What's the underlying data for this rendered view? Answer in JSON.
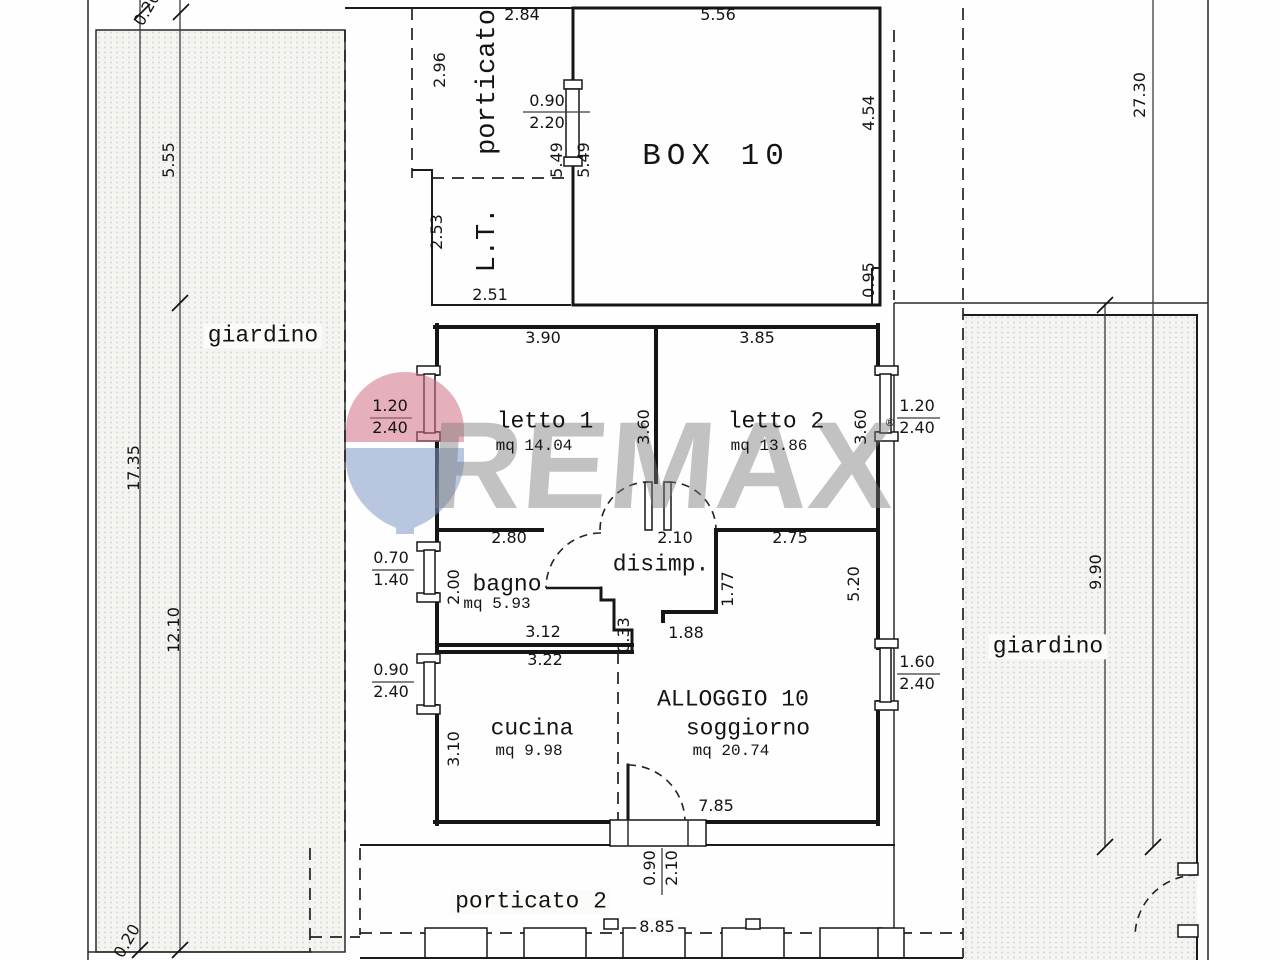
{
  "watermark": {
    "brand": "REMAX",
    "balloon_top_color": "#cf6d84",
    "balloon_bottom_color": "#7d99c4",
    "text_color": "rgba(122,122,122,0.45)"
  },
  "plan": {
    "unit": "ALLOGGIO 10",
    "rooms": [
      {
        "name": "porticato"
      },
      {
        "name": "L.T."
      },
      {
        "name": "BOX 10"
      },
      {
        "name": "letto 1",
        "area": "mq 14.04"
      },
      {
        "name": "letto 2",
        "area": "mq 13.86"
      },
      {
        "name": "bagno",
        "area": "mq 5.93"
      },
      {
        "name": "disimp."
      },
      {
        "name": "cucina",
        "area": "mq 9.98"
      },
      {
        "name": "soggiorno",
        "area": "mq 20.74"
      },
      {
        "name": "giardino"
      },
      {
        "name": "giardino"
      },
      {
        "name": "porticato 2"
      }
    ],
    "labels": [
      {
        "n": "room-label-porticato",
        "t": "porticato",
        "x": 489,
        "y": 82,
        "r": -90,
        "s": 27,
        "c": "r"
      },
      {
        "n": "dim-2-84",
        "t": "2.84",
        "x": 522,
        "y": 15
      },
      {
        "n": "dim-5-56",
        "t": "5.56",
        "x": 718,
        "y": 15
      },
      {
        "n": "dim-2-96",
        "t": "2.96",
        "x": 440,
        "y": 70,
        "r": -90
      },
      {
        "n": "dim-0-90-box-door",
        "t": "0.90",
        "x": 547,
        "y": 101
      },
      {
        "n": "dim-2-20-box-door",
        "t": "2.20",
        "x": 547,
        "y": 123
      },
      {
        "n": "dim-5-49-a",
        "t": "5.49",
        "x": 557,
        "y": 160,
        "r": -90
      },
      {
        "n": "dim-5-49-b",
        "t": "5.49",
        "x": 584,
        "y": 160,
        "r": -90
      },
      {
        "n": "room-label-lt",
        "t": "L.T.",
        "x": 489,
        "y": 240,
        "r": -90,
        "s": 27,
        "c": "r"
      },
      {
        "n": "dim-2-53",
        "t": "2.53",
        "x": 437,
        "y": 232,
        "r": -90
      },
      {
        "n": "dim-2-51",
        "t": "2.51",
        "x": 490,
        "y": 295
      },
      {
        "n": "room-label-box-10",
        "t": "BOX 10",
        "x": 716,
        "y": 157,
        "s": 31,
        "c": "b"
      },
      {
        "n": "dim-4-54",
        "t": "4.54",
        "x": 869,
        "y": 113,
        "r": -90
      },
      {
        "n": "dim-0-95",
        "t": "0.95",
        "x": 869,
        "y": 280,
        "r": -90
      },
      {
        "n": "room-label-giardino-left",
        "t": "giardino",
        "x": 263,
        "y": 336,
        "s": 23,
        "c": "w"
      },
      {
        "n": "dim-5-55",
        "t": "5.55",
        "x": 169,
        "y": 160,
        "r": -90
      },
      {
        "n": "dim-17-35",
        "t": "17.35",
        "x": 134,
        "y": 468,
        "r": -90
      },
      {
        "n": "dim-12-10",
        "t": "12.10",
        "x": 174,
        "y": 630,
        "r": -90
      },
      {
        "n": "dim-0-20-top",
        "t": "0.20",
        "x": 147,
        "y": 9,
        "r": -60
      },
      {
        "n": "dim-0-20-bottom",
        "t": "0.20",
        "x": 127,
        "y": 941,
        "r": -60
      },
      {
        "n": "dim-27-30",
        "t": "27.30",
        "x": 1140,
        "y": 95,
        "r": -90
      },
      {
        "n": "dim-9-90",
        "t": "9.90",
        "x": 1096,
        "y": 572,
        "r": -90
      },
      {
        "n": "dim-3-90",
        "t": "3.90",
        "x": 543,
        "y": 338
      },
      {
        "n": "room-label-letto-1",
        "t": "letto 1",
        "x": 545,
        "y": 422,
        "s": 23,
        "c": "r"
      },
      {
        "n": "area-letto-1",
        "t": "mq 14.04",
        "x": 534,
        "y": 447,
        "c": "m"
      },
      {
        "n": "dim-3-60-left",
        "t": "3.60",
        "x": 644,
        "y": 427,
        "r": -90
      },
      {
        "n": "dim-3-85",
        "t": "3.85",
        "x": 757,
        "y": 338
      },
      {
        "n": "room-label-letto-2",
        "t": "letto 2",
        "x": 776,
        "y": 422,
        "s": 23,
        "c": "r"
      },
      {
        "n": "area-letto-2",
        "t": "mq 13.86",
        "x": 769,
        "y": 447,
        "c": "m"
      },
      {
        "n": "dim-3-60-right",
        "t": "3.60",
        "x": 861,
        "y": 427,
        "r": -90
      },
      {
        "n": "dim-1-20-left",
        "t": "1.20",
        "x": 390,
        "y": 406
      },
      {
        "n": "dim-2-40-left",
        "t": "2.40",
        "x": 390,
        "y": 428
      },
      {
        "n": "dim-1-20-right",
        "t": "1.20",
        "x": 917,
        "y": 406
      },
      {
        "n": "dim-2-40-right",
        "t": "2.40",
        "x": 917,
        "y": 428
      },
      {
        "n": "dim-2-80",
        "t": "2.80",
        "x": 509,
        "y": 538
      },
      {
        "n": "dim-2-10-disimp",
        "t": "2.10",
        "x": 675,
        "y": 538
      },
      {
        "n": "dim-2-75",
        "t": "2.75",
        "x": 790,
        "y": 538
      },
      {
        "n": "room-label-bagno",
        "t": "bagno",
        "x": 507,
        "y": 585,
        "s": 23,
        "c": "r"
      },
      {
        "n": "area-bagno",
        "t": "mq 5.93",
        "x": 497,
        "y": 605,
        "c": "m"
      },
      {
        "n": "room-label-disimp",
        "t": "disimp.",
        "x": 661,
        "y": 565,
        "s": 23,
        "c": "r"
      },
      {
        "n": "dim-0-70",
        "t": "0.70",
        "x": 391,
        "y": 558
      },
      {
        "n": "dim-1-40",
        "t": "1.40",
        "x": 391,
        "y": 580
      },
      {
        "n": "dim-2-00",
        "t": "2.00",
        "x": 454,
        "y": 587,
        "r": -90
      },
      {
        "n": "dim-1-77",
        "t": "1.77",
        "x": 728,
        "y": 589,
        "r": -90
      },
      {
        "n": "dim-5-20",
        "t": "5.20",
        "x": 854,
        "y": 584,
        "r": -90
      },
      {
        "n": "dim-3-12",
        "t": "3.12",
        "x": 543,
        "y": 632
      },
      {
        "n": "dim-0-33",
        "t": "0.33",
        "x": 624,
        "y": 635,
        "r": -90
      },
      {
        "n": "dim-1-88",
        "t": "1.88",
        "x": 686,
        "y": 633
      },
      {
        "n": "dim-0-90-cucina",
        "t": "0.90",
        "x": 391,
        "y": 670
      },
      {
        "n": "dim-2-40-cucina",
        "t": "2.40",
        "x": 391,
        "y": 692
      },
      {
        "n": "dim-1-60",
        "t": "1.60",
        "x": 917,
        "y": 662
      },
      {
        "n": "dim-2-40-soggiorno",
        "t": "2.40",
        "x": 917,
        "y": 684
      },
      {
        "n": "dim-3-22",
        "t": "3.22",
        "x": 545,
        "y": 660
      },
      {
        "n": "dim-3-10",
        "t": "3.10",
        "x": 454,
        "y": 749,
        "r": -90
      },
      {
        "n": "room-label-cucina",
        "t": "cucina",
        "x": 532,
        "y": 729,
        "s": 23,
        "c": "r"
      },
      {
        "n": "area-cucina",
        "t": "mq 9.98",
        "x": 529,
        "y": 752,
        "c": "m"
      },
      {
        "n": "unit-label-alloggio-10",
        "t": "ALLOGGIO 10",
        "x": 733,
        "y": 700,
        "s": 23,
        "c": "r"
      },
      {
        "n": "room-label-soggiorno",
        "t": "soggiorno",
        "x": 748,
        "y": 729,
        "s": 23,
        "c": "r"
      },
      {
        "n": "area-soggiorno",
        "t": "mq 20.74",
        "x": 731,
        "y": 752,
        "c": "m"
      },
      {
        "n": "dim-7-85",
        "t": "7.85",
        "x": 716,
        "y": 806
      },
      {
        "n": "room-label-giardino-right",
        "t": "giardino",
        "x": 1048,
        "y": 647,
        "s": 23,
        "c": "w"
      },
      {
        "n": "dim-0-90-main-door",
        "t": "0.90",
        "x": 650,
        "y": 868,
        "r": -90
      },
      {
        "n": "dim-2-10-main-door",
        "t": "2.10",
        "x": 672,
        "y": 868,
        "r": -90
      },
      {
        "n": "room-label-porticato-2",
        "t": "porticato 2",
        "x": 531,
        "y": 902,
        "s": 23,
        "c": "w"
      },
      {
        "n": "dim-8-85",
        "t": "8.85",
        "x": 657,
        "y": 927,
        "c": "wd"
      },
      {
        "n": "registered-mark",
        "t": "®",
        "x": 890,
        "y": 423,
        "s": 11
      }
    ]
  }
}
